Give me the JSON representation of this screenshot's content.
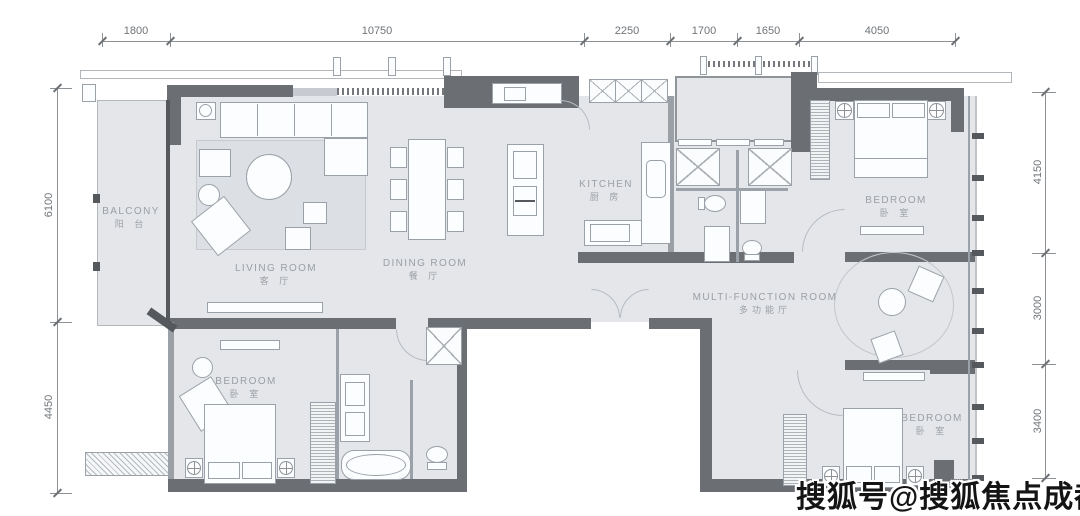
{
  "dims": {
    "top": {
      "d1": "1800",
      "d2": "10750",
      "d3": "2250",
      "d4": "1700",
      "d5": "1650",
      "d6": "4050"
    },
    "left": {
      "d1": "6100",
      "d2": "4450"
    },
    "right": {
      "d1": "4150",
      "d2": "3000",
      "d3": "3400"
    }
  },
  "rooms": {
    "balcony": {
      "en": "BALCONY",
      "zh": "阳 台"
    },
    "living": {
      "en": "LIVING ROOM",
      "zh": "客 厅"
    },
    "dining": {
      "en": "DINING ROOM",
      "zh": "餐 厅"
    },
    "kitchen": {
      "en": "KITCHEN",
      "zh": "厨 房"
    },
    "bedroom_tr": {
      "en": "BEDROOM",
      "zh": "卧 室"
    },
    "multifunction": {
      "en": "MULTI-FUNCTION ROOM",
      "zh": "多功能厅"
    },
    "bedroom_bl": {
      "en": "BEDROOM",
      "zh": "卧 室"
    },
    "bedroom_br": {
      "en": "BEDROOM",
      "zh": "卧 室"
    }
  },
  "watermark": {
    "text": "搜狐号@搜狐焦点成都站"
  },
  "colors": {
    "wall": "#6b6e72",
    "floor": "#e4e6e9",
    "dimension": "#6f7478",
    "label": "#9aa0a6",
    "watermark": "#141414"
  }
}
